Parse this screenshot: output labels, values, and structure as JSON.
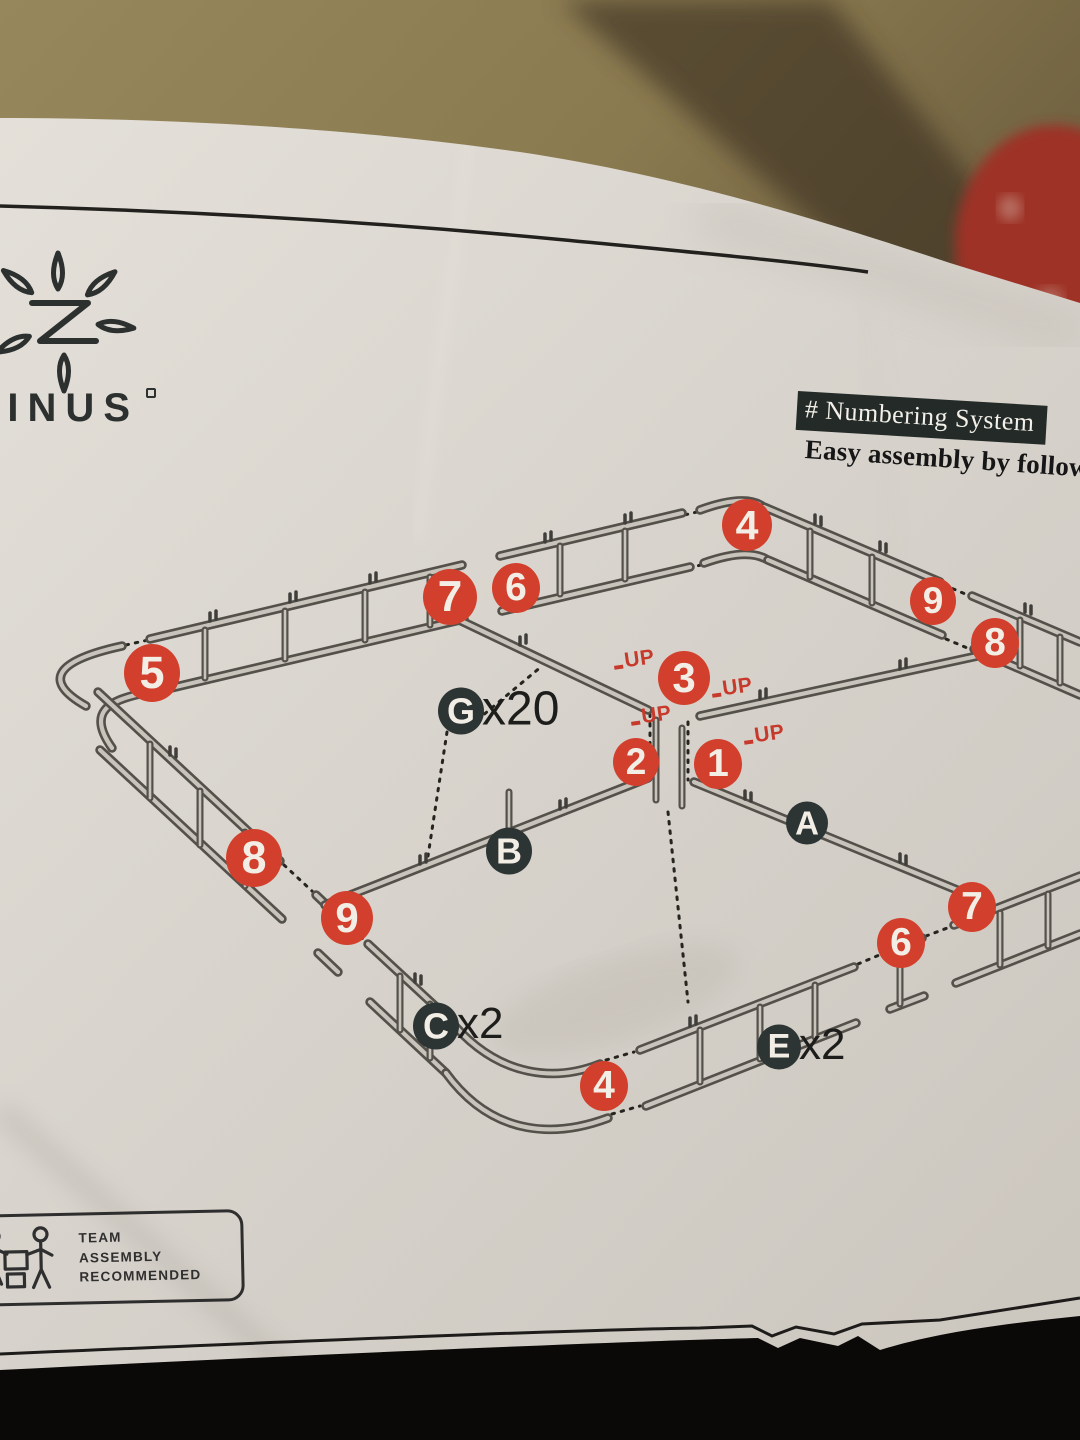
{
  "scene": {
    "background": {
      "cardboard": "#8c7c53",
      "shadow_band": "#3e3321",
      "red_object": "#9e3126",
      "below_surface": "#0b0908"
    },
    "paper": {
      "base": "#d9d5ce",
      "light": "#e8e4dd",
      "dark": "#c2bdb4"
    }
  },
  "brand": {
    "wordmark": "ZINUS",
    "logo_icon": "zinus-botanical-monogram"
  },
  "header": {
    "tag_label": "# Numbering System",
    "tagline": "Easy assembly by following",
    "tag_bg": "#232a28",
    "tag_text_color": "#f3f0e9"
  },
  "team_badge": {
    "line1": "TEAM",
    "line2": "ASSEMBLY",
    "line3": "RECOMMENDED",
    "icon": "team-carry-icon"
  },
  "diagram": {
    "description": "Isometric exploded view of bed base frame with numbered connection steps",
    "step_color": "#d2402d",
    "part_color": "#2c3434",
    "frame_color": "#54514b",
    "steps": [
      {
        "n": "4",
        "x": 747,
        "y": 525,
        "r": 25
      },
      {
        "n": "7",
        "x": 450,
        "y": 597,
        "r": 27
      },
      {
        "n": "6",
        "x": 516,
        "y": 588,
        "r": 24
      },
      {
        "n": "9",
        "x": 933,
        "y": 601,
        "r": 23
      },
      {
        "n": "8",
        "x": 995,
        "y": 643,
        "r": 24
      },
      {
        "n": "5",
        "x": 152,
        "y": 673,
        "r": 28
      },
      {
        "n": "3",
        "x": 684,
        "y": 678,
        "r": 26
      },
      {
        "n": "2",
        "x": 636,
        "y": 762,
        "r": 23
      },
      {
        "n": "1",
        "x": 718,
        "y": 764,
        "r": 24
      },
      {
        "n": "8",
        "x": 254,
        "y": 858,
        "r": 28
      },
      {
        "n": "9",
        "x": 347,
        "y": 918,
        "r": 26
      },
      {
        "n": "6",
        "x": 901,
        "y": 943,
        "r": 24
      },
      {
        "n": "7",
        "x": 972,
        "y": 907,
        "r": 24
      },
      {
        "n": "4",
        "x": 604,
        "y": 1086,
        "r": 24
      }
    ],
    "parts": [
      {
        "id": "G",
        "x": 461,
        "y": 711,
        "r": 23,
        "qty": "x20",
        "qty_size": 48
      },
      {
        "id": "B",
        "x": 509,
        "y": 851,
        "r": 23,
        "qty": "",
        "qty_size": 0
      },
      {
        "id": "A",
        "x": 807,
        "y": 823,
        "r": 21,
        "qty": "",
        "qty_size": 0
      },
      {
        "id": "C",
        "x": 436,
        "y": 1026,
        "r": 23,
        "qty": "x2",
        "qty_size": 44
      },
      {
        "id": "E",
        "x": 779,
        "y": 1047,
        "r": 22,
        "qty": "x2",
        "qty_size": 44
      }
    ],
    "up_markers": [
      {
        "text": "UP",
        "x": 634,
        "y": 660
      },
      {
        "text": "UP",
        "x": 732,
        "y": 688
      },
      {
        "text": "UP",
        "x": 651,
        "y": 716
      },
      {
        "text": "UP",
        "x": 764,
        "y": 735
      }
    ]
  }
}
